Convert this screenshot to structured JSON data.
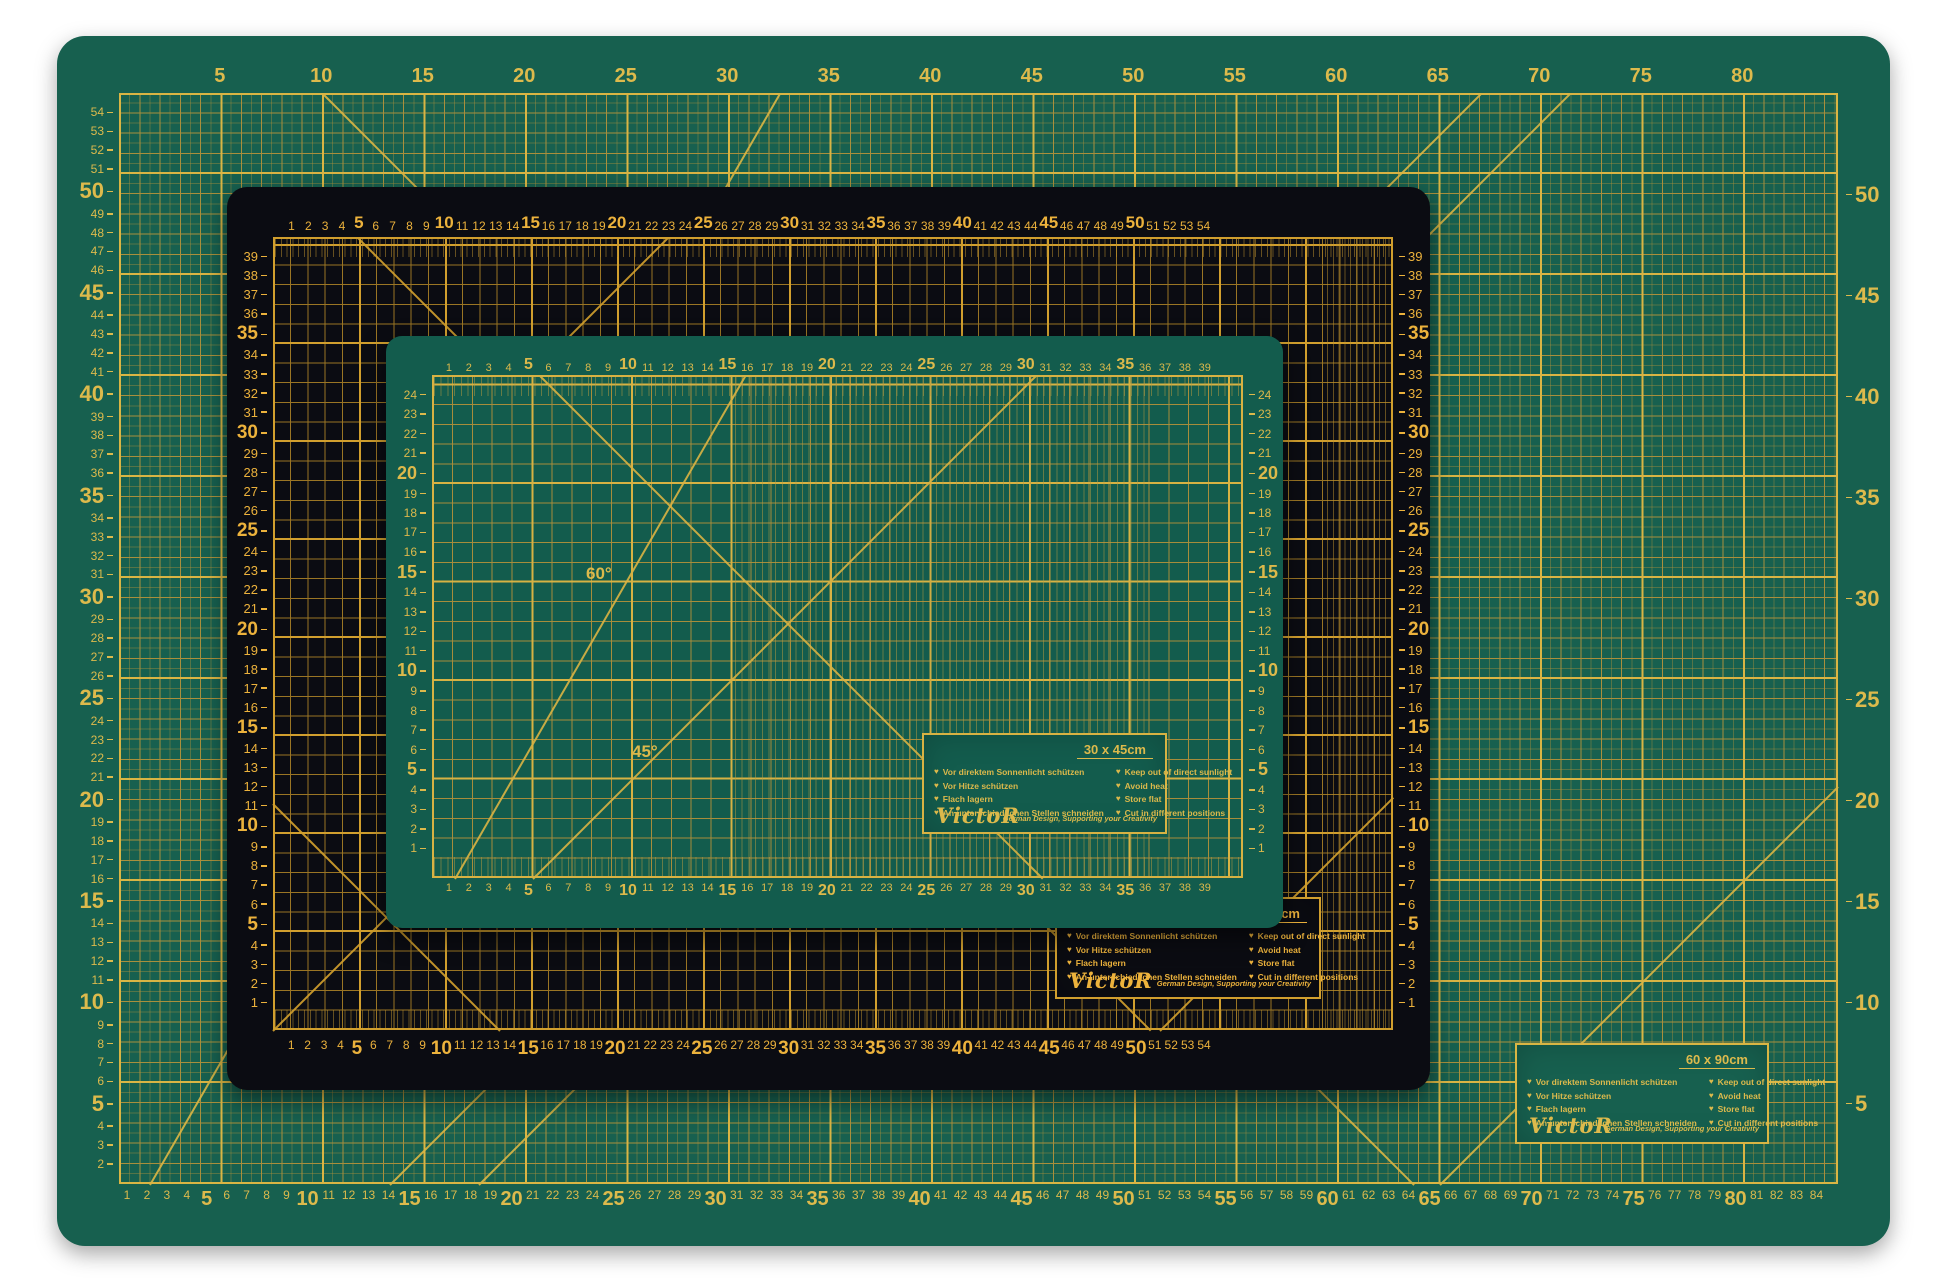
{
  "scene": {
    "background_color": "#ffffff"
  },
  "brand_card": {
    "bullet": "♥",
    "german_lines": [
      "Vor direktem Sonnenlicht schützen",
      "Vor Hitze schützen",
      "Flach lagern",
      "An unterschiedlichen Stellen schneiden"
    ],
    "english_lines": [
      "Keep out of direct sunlight",
      "Avoid heat",
      "Store flat",
      "Cut in different positions"
    ],
    "brand": "VictoR",
    "tagline": "German Design, Supporting your Creativity"
  },
  "mats": {
    "large": {
      "size_label": "60 x 90cm",
      "surface_color": "#17604f",
      "line_color": "#a98f3c",
      "bold_line_color": "#d9b544",
      "number_color": "#ddba4c",
      "rulers": {
        "top": {
          "from": 5,
          "to": 80,
          "step": 5,
          "bold_every": 5
        },
        "bottom": {
          "from": 1,
          "to": 84,
          "step": 1,
          "bold_every": 5
        },
        "left": {
          "from": 54,
          "to": 2,
          "step": -1,
          "bold_every": 5
        },
        "right": {
          "from": 50,
          "to": 5,
          "step": -5,
          "bold_every": 5
        }
      }
    },
    "black": {
      "size_label": "45 x 60cm",
      "surface_color": "#0b0c12",
      "line_color": "#9a7524",
      "bold_line_color": "#d19f2e",
      "number_color": "#ecb23c",
      "rulers": {
        "top": {
          "from": 1,
          "to": 54,
          "step": 1,
          "bold_every": 5
        },
        "bottom": {
          "from": 1,
          "to": 54,
          "step": 1,
          "bold_every": 5
        },
        "left": {
          "from": 39,
          "to": 1,
          "step": -1,
          "bold_every": 5
        },
        "right": {
          "from": 39,
          "to": 1,
          "step": -1,
          "bold_every": 5
        }
      }
    },
    "small": {
      "size_label": "30 x 45cm",
      "surface_color": "#135c4d",
      "line_color": "#a78d3b",
      "bold_line_color": "#d7b243",
      "number_color": "#dcb94b",
      "angle_labels": [
        {
          "text": "60°"
        },
        {
          "text": "45°"
        }
      ],
      "rulers": {
        "top": {
          "from": 1,
          "to": 39,
          "step": 1,
          "bold_every": 5
        },
        "bottom": {
          "from": 1,
          "to": 39,
          "step": 1,
          "bold_every": 5
        },
        "left": {
          "from": 24,
          "to": 1,
          "step": -1,
          "bold_every": 5
        },
        "right": {
          "from": 24,
          "to": 1,
          "step": -1,
          "bold_every": 5
        }
      }
    }
  }
}
